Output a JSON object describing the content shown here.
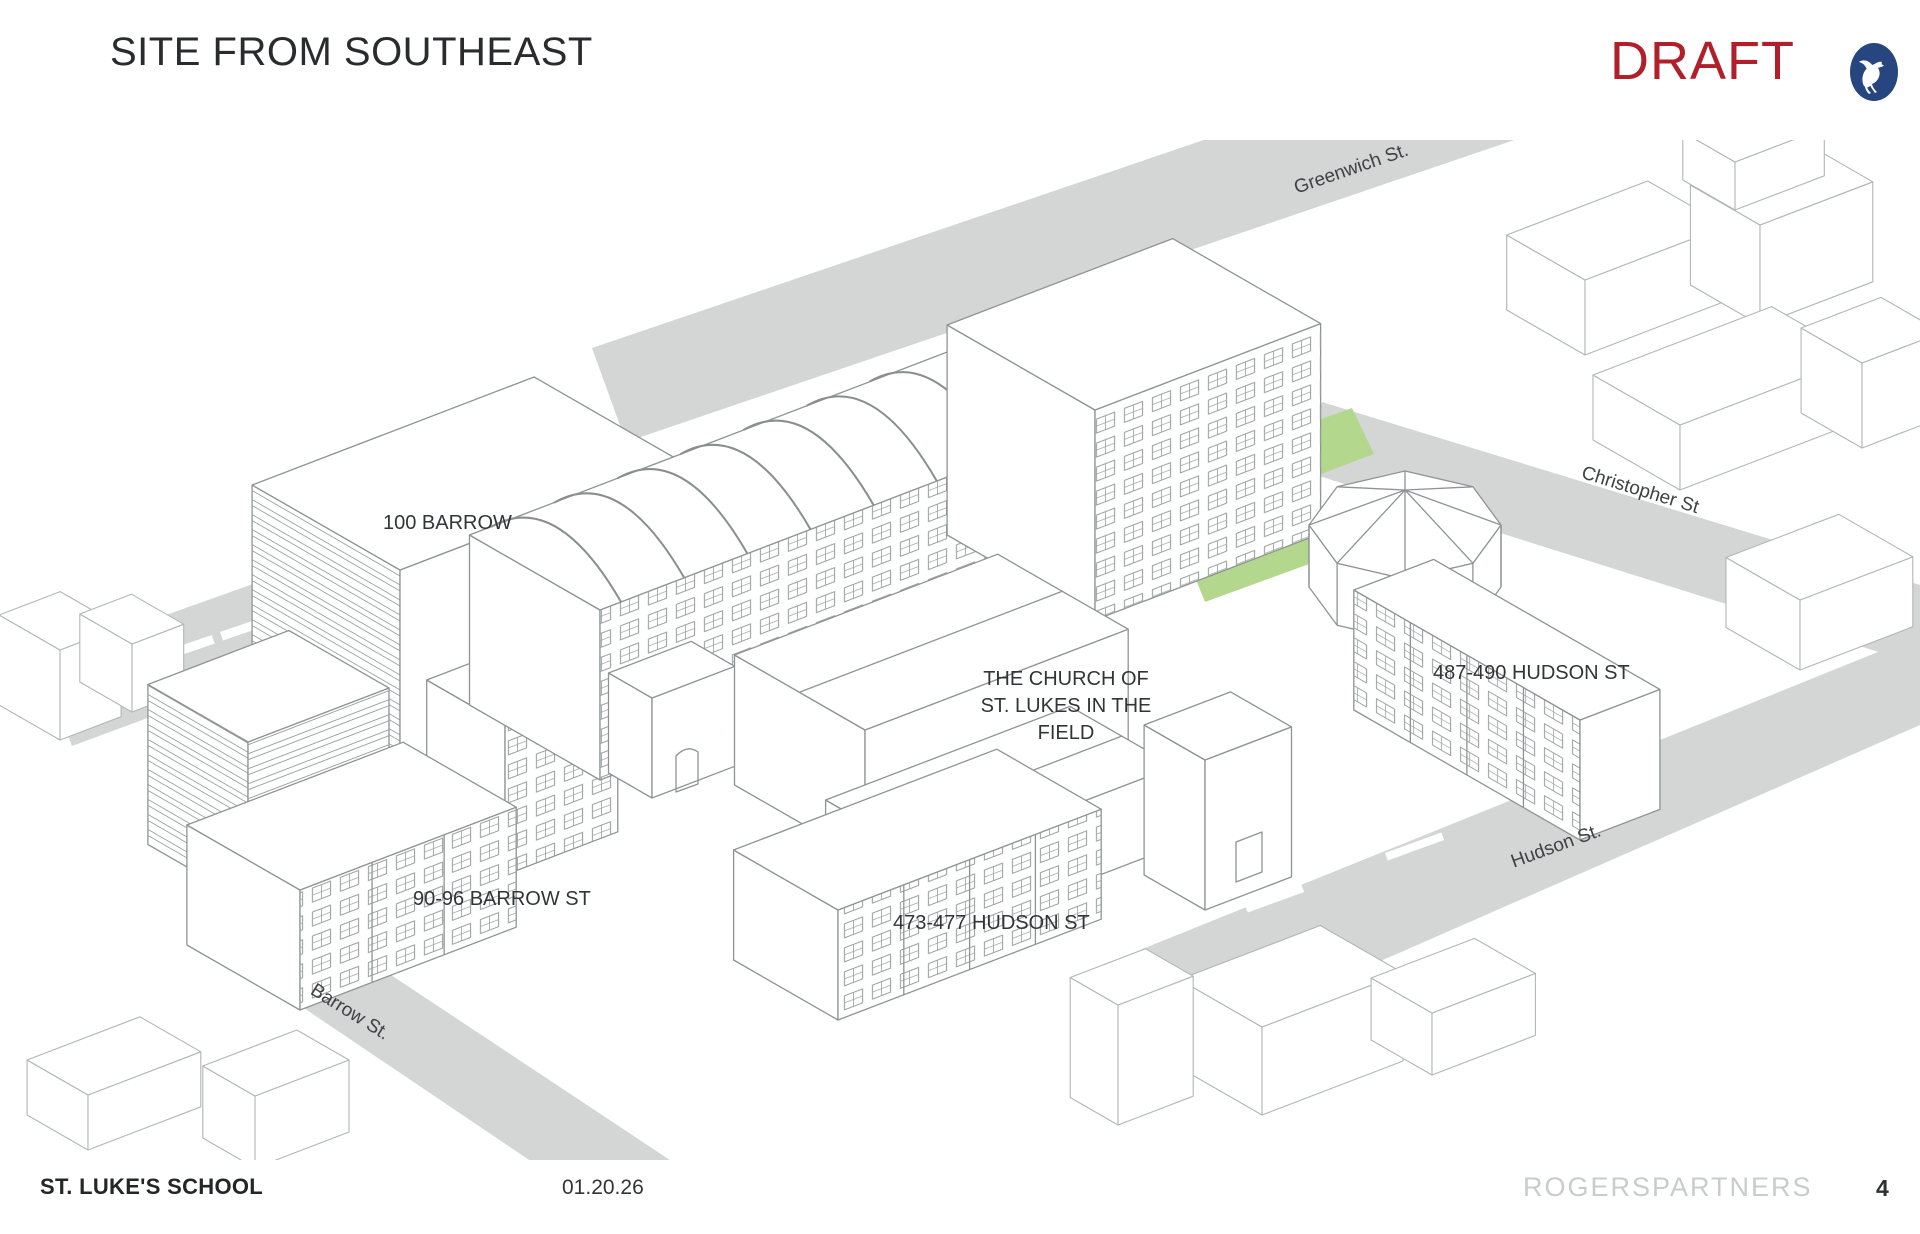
{
  "header": {
    "title": "SITE FROM SOUTHEAST",
    "draft_label": "DRAFT"
  },
  "footer": {
    "project": "ST. LUKE'S SCHOOL",
    "date": "01.20.26",
    "firm": "ROGERSPARTNERS",
    "page_number": "4"
  },
  "drawing": {
    "building_labels": {
      "barrow_100": "100 BARROW",
      "barrow_90_96": "90-96 BARROW ST",
      "hudson_473_477": "473-477 HUDSON ST",
      "hudson_487_490": "487-490 HUDSON ST",
      "church_line1": "THE CHURCH OF",
      "church_line2": "ST. LUKES IN THE",
      "church_line3": "FIELD"
    },
    "street_labels": {
      "greenwich": "Greenwich St.",
      "christopher": "Christopher St",
      "hudson": "Hudson St.",
      "barrow": "Barrow St."
    },
    "colors": {
      "draft_red": "#B0202A",
      "logo_navy": "#27467F",
      "landscape_green": "#B3D88D",
      "street_gray": "#D3D6D5"
    }
  }
}
